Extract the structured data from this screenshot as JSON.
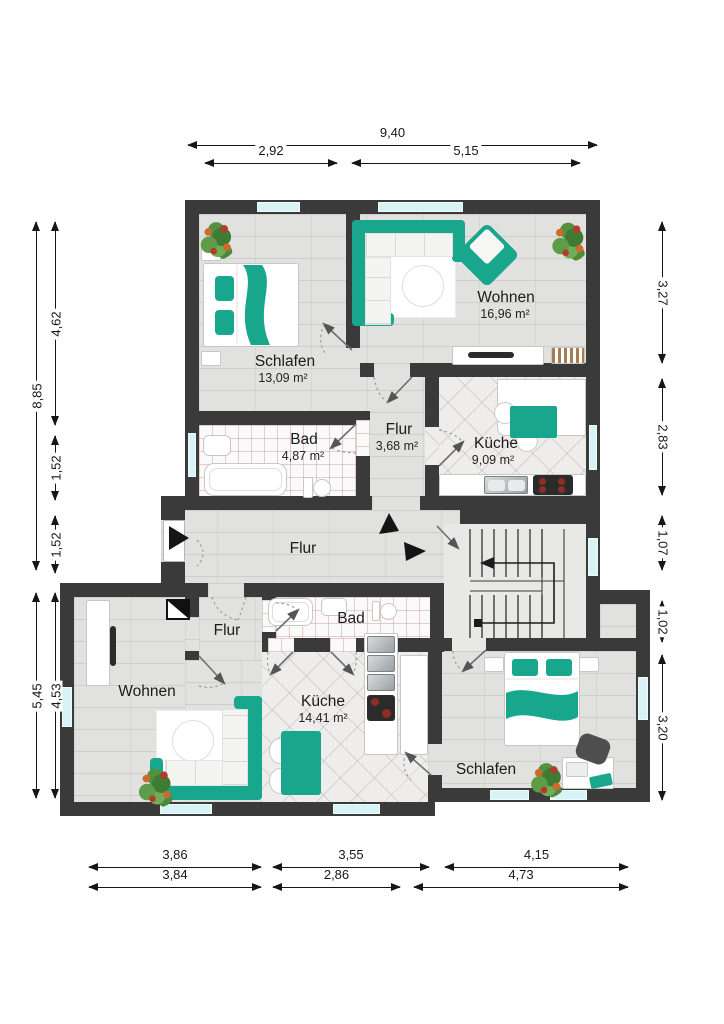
{
  "colors": {
    "accent": "#18a78c",
    "wall": "#3a3a3a",
    "window": "#d8f3f6"
  },
  "dimensions": {
    "top_total": "9,40",
    "top_segments": [
      "2,92",
      "5,15"
    ],
    "left": [
      "8,85",
      "4,62",
      "1,52",
      "1,52",
      "5,45",
      "4,53"
    ],
    "right": [
      "3,27",
      "2,83",
      "1,07",
      "1,02",
      "3,20"
    ],
    "bottom_row1": [
      "3,86",
      "3,55",
      "4,15"
    ],
    "bottom_row2": [
      "3,84",
      "2,86",
      "4,73"
    ]
  },
  "rooms": {
    "schlafen_top": {
      "name": "Schlafen",
      "area": "13,09 m²"
    },
    "wohnen_top": {
      "name": "Wohnen",
      "area": "16,96 m²"
    },
    "bad_top": {
      "name": "Bad",
      "area": "4,87 m²"
    },
    "flur_top": {
      "name": "Flur",
      "area": "3,68 m²"
    },
    "kueche_top": {
      "name": "Küche",
      "area": "9,09 m²"
    },
    "flur_mid": {
      "name": "Flur"
    },
    "flur_low": {
      "name": "Flur"
    },
    "bad_low": {
      "name": "Bad"
    },
    "wohnen_low": {
      "name": "Wohnen"
    },
    "kueche_low": {
      "name": "Küche",
      "area": "14,41 m²"
    },
    "schlafen_low": {
      "name": "Schlafen"
    }
  }
}
